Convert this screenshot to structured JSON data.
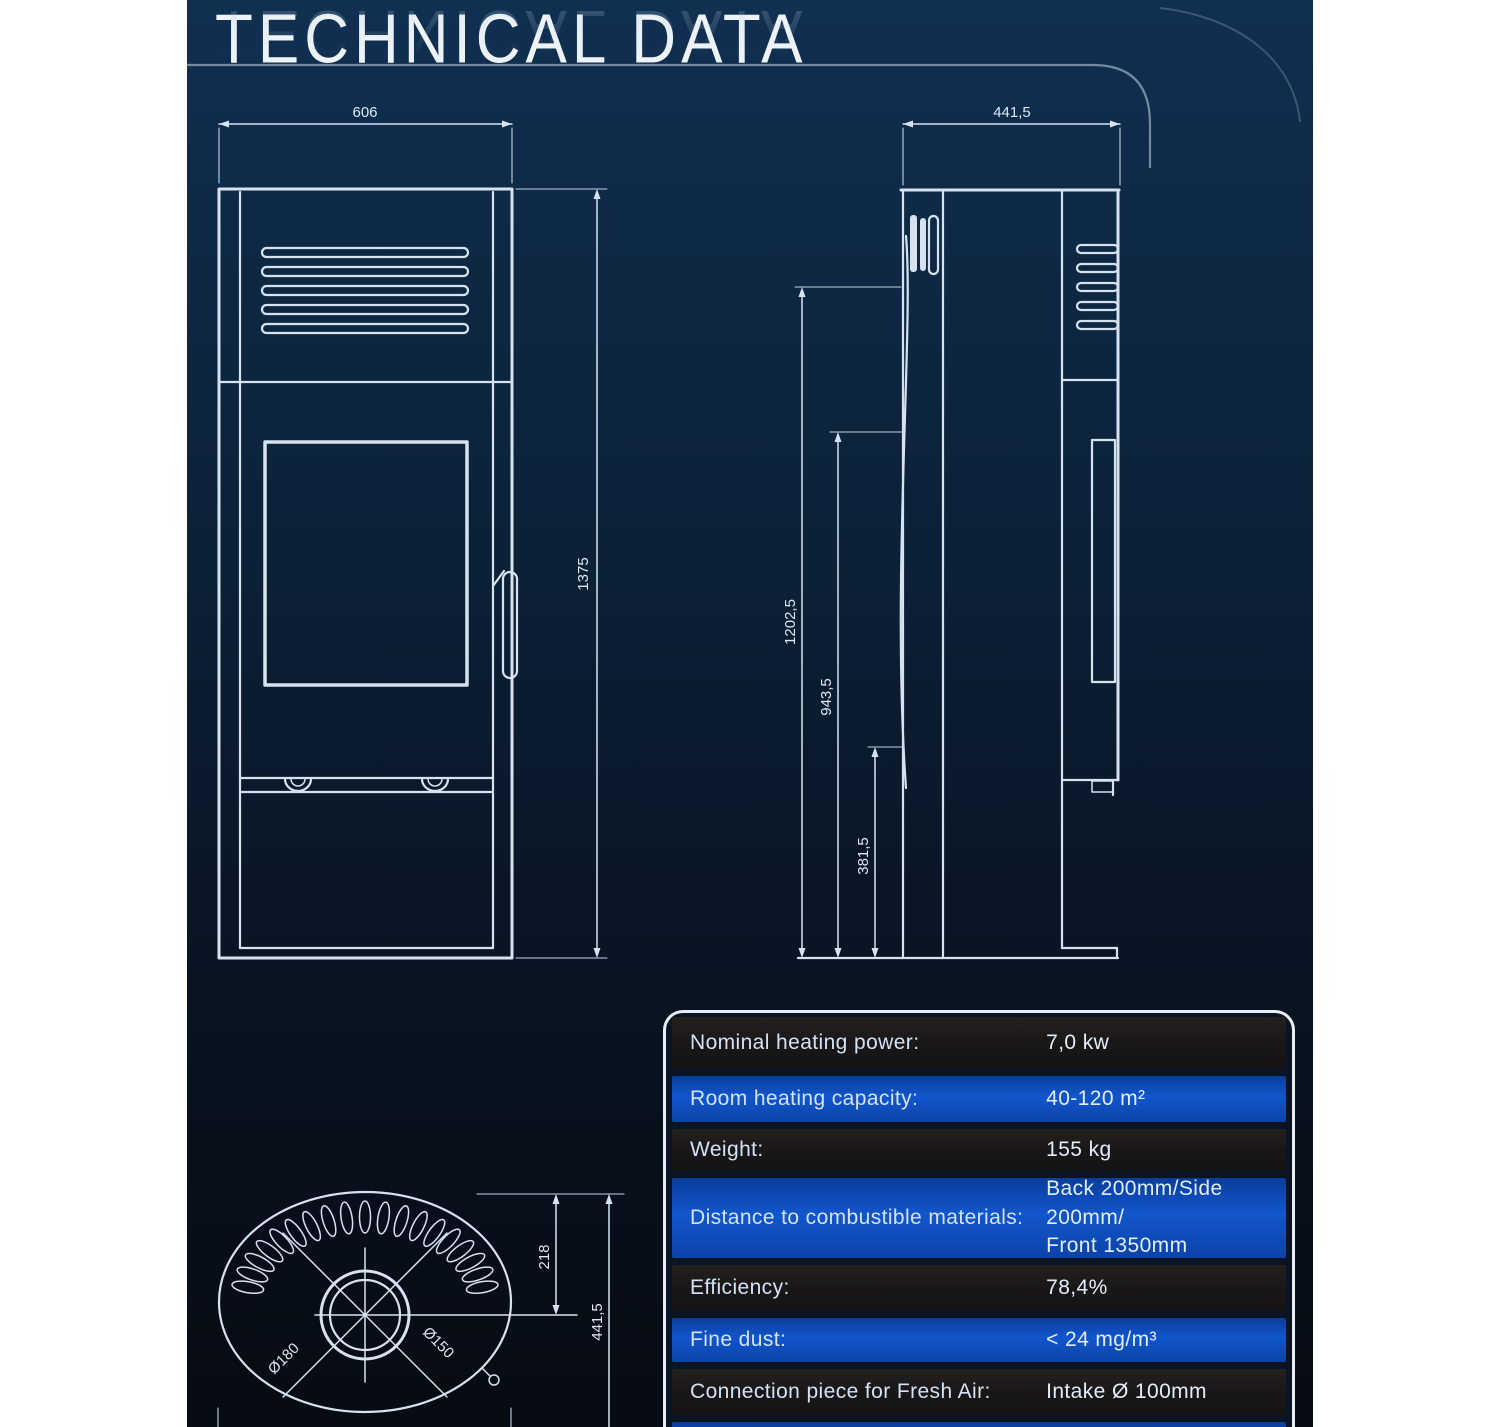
{
  "title": {
    "text": "TECHNICAL DATA"
  },
  "drawings": {
    "front_view": {
      "width_dim": "606",
      "height_dim": "1375"
    },
    "side_view": {
      "depth_dim": "441,5",
      "height_total_dim": "1202,5",
      "height_mid_dim": "943,5",
      "height_low_dim": "381,5"
    },
    "top_view": {
      "flue_offset_dim": "218",
      "depth_dim": "441,5",
      "flue_outer_dim": "Ø180",
      "flue_inner_dim": "Ø150"
    }
  },
  "table": {
    "rows": [
      {
        "label": "Nominal heating power:",
        "value": "7,0 kw",
        "tone": "dark"
      },
      {
        "label": "Room heating capacity:",
        "value": "40-120 m²",
        "tone": "blue"
      },
      {
        "label": "Weight:",
        "value": "155 kg",
        "tone": "dark"
      },
      {
        "label": "Distance to combustible materials:",
        "value": "Back 200mm/Side 200mm/\nFront 1350mm",
        "tone": "blue"
      },
      {
        "label": "Efficiency:",
        "value": "78,4%",
        "tone": "dark"
      },
      {
        "label": "Fine dust:",
        "value": "< 24 mg/m³",
        "tone": "blue"
      },
      {
        "label": "Connection piece for Fresh Air:",
        "value": "Intake Ø 100mm",
        "tone": "dark"
      },
      {
        "label": "",
        "value": "",
        "tone": "blue"
      }
    ]
  },
  "colors": {
    "background_top": "#103052",
    "background_bottom": "#070b13",
    "line": "#d6e3ef",
    "table_blue": "#1156cc",
    "table_dark": "#191617",
    "page_margin": "#ffffff"
  }
}
